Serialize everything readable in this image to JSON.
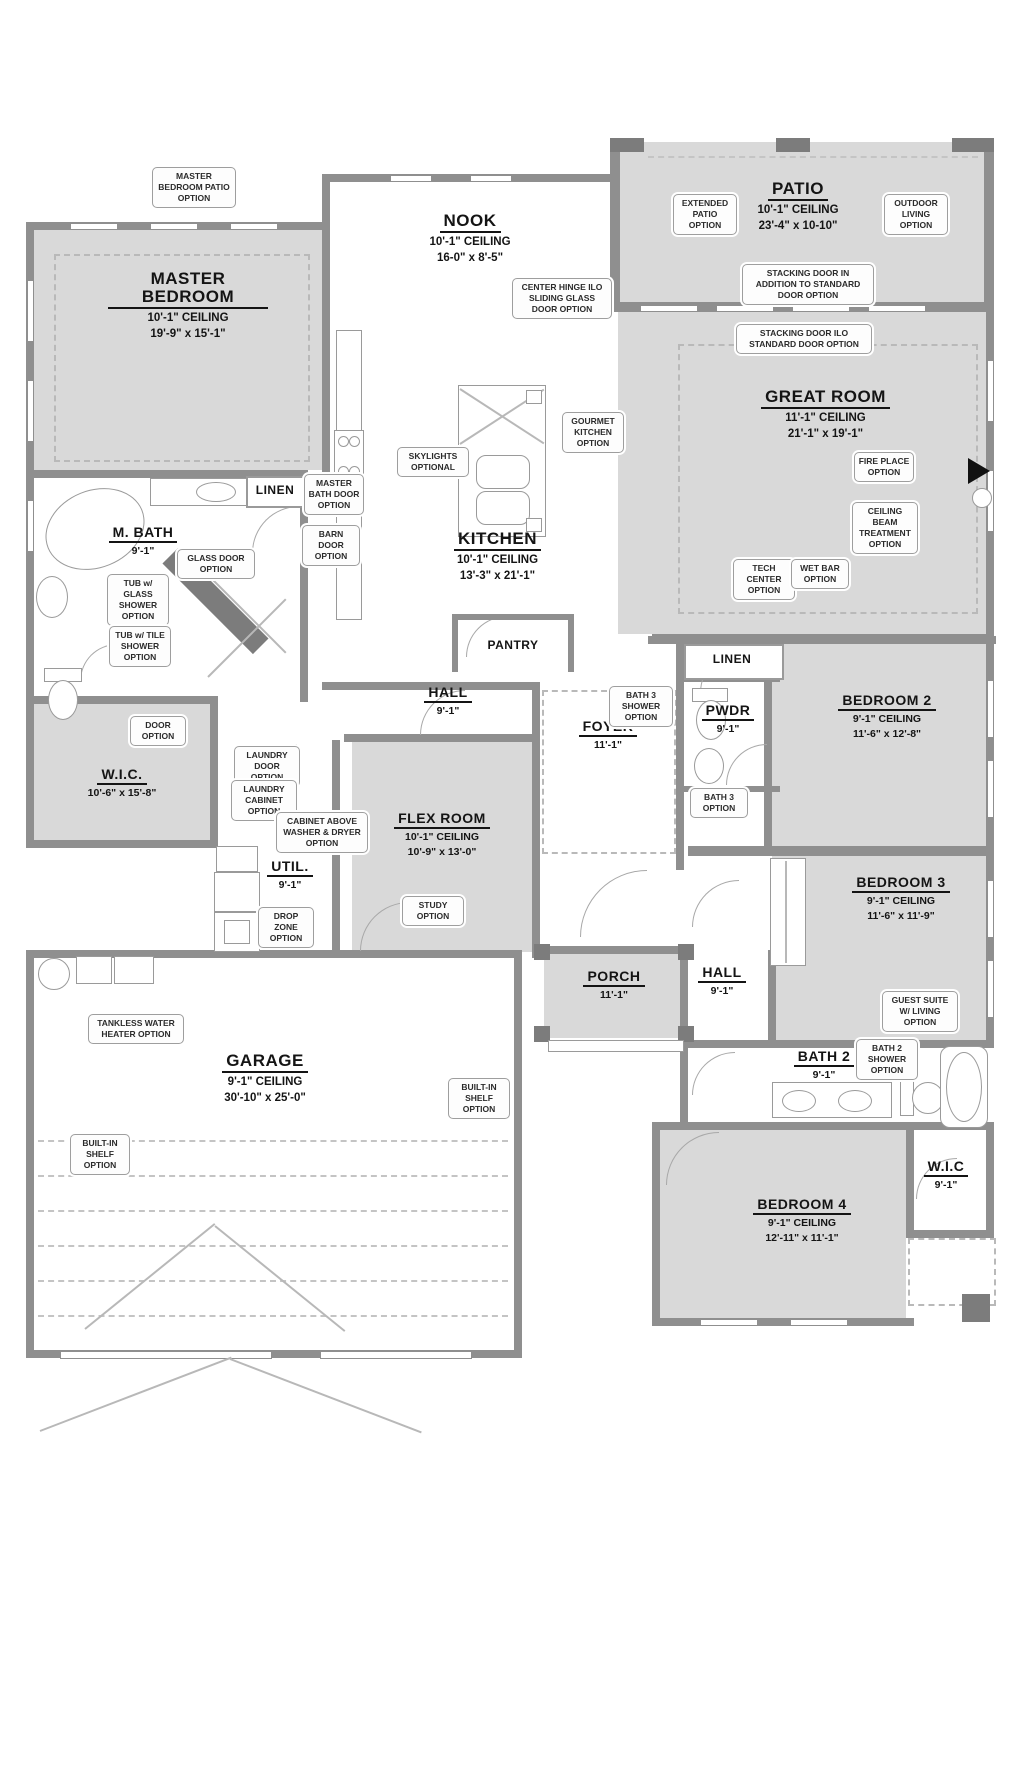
{
  "plan": {
    "title": "Floor Plan",
    "rooms": {
      "master_bedroom": {
        "name": "MASTER BEDROOM",
        "ceiling": "10'-1\" CEILING",
        "dims": "19'-9\" x 15'-1\""
      },
      "nook": {
        "name": "NOOK",
        "ceiling": "10'-1\" CEILING",
        "dims": "16-0\" x 8'-5\""
      },
      "patio": {
        "name": "PATIO",
        "ceiling": "10'-1\" CEILING",
        "dims": "23'-4\" x 10-10\""
      },
      "great_room": {
        "name": "GREAT ROOM",
        "ceiling": "11'-1\" CEILING",
        "dims": "21'-1\" x 19'-1\""
      },
      "kitchen": {
        "name": "KITCHEN",
        "ceiling": "10'-1\" CEILING",
        "dims": "13'-3\" x 21'-1\""
      },
      "m_bath": {
        "name": "M. BATH",
        "ceiling": "9'-1\""
      },
      "linen_master": {
        "name": "LINEN"
      },
      "pantry": {
        "name": "PANTRY"
      },
      "hall_center": {
        "name": "HALL",
        "ceiling": "9'-1\""
      },
      "foyer": {
        "name": "FOYER",
        "ceiling": "11'-1\""
      },
      "linen_hall": {
        "name": "LINEN"
      },
      "pwdr": {
        "name": "PWDR",
        "ceiling": "9'-1\""
      },
      "wic_master": {
        "name": "W.I.C.",
        "dims": "10'-6\" x 15'-8\""
      },
      "util": {
        "name": "UTIL.",
        "ceiling": "9'-1\""
      },
      "flex_room": {
        "name": "FLEX ROOM",
        "ceiling": "10'-1\" CEILING",
        "dims": "10'-9\" x 13'-0\""
      },
      "bedroom_2": {
        "name": "BEDROOM 2",
        "ceiling": "9'-1\" CEILING",
        "dims": "11'-6\" x 12'-8\""
      },
      "bedroom_3": {
        "name": "BEDROOM 3",
        "ceiling": "9'-1\" CEILING",
        "dims": "11'-6\" x 11'-9\""
      },
      "porch": {
        "name": "PORCH",
        "ceiling": "11'-1\""
      },
      "hall_bed": {
        "name": "HALL",
        "ceiling": "9'-1\""
      },
      "bath_2": {
        "name": "BATH 2",
        "ceiling": "9'-1\""
      },
      "garage": {
        "name": "GARAGE",
        "ceiling": "9'-1\" CEILING",
        "dims": "30'-10\" x 25'-0\""
      },
      "bedroom_4": {
        "name": "BEDROOM 4",
        "ceiling": "9'-1\" CEILING",
        "dims": "12'-11\" x 11'-1\""
      },
      "wic_bed4": {
        "name": "W.I.C",
        "ceiling": "9'-1\""
      }
    },
    "options": {
      "master_patio": "MASTER BEDROOM PATIO OPTION",
      "center_hinge": "CENTER HINGE ILO SLIDING GLASS DOOR OPTION",
      "extended_patio": "EXTENDED PATIO OPTION",
      "outdoor_living": "OUTDOOR LIVING OPTION",
      "stacking_addition": "STACKING DOOR IN ADDITION TO STANDARD DOOR OPTION",
      "stacking_ilo": "STACKING DOOR ILO STANDARD DOOR OPTION",
      "gourmet_kitchen": "GOURMET KITCHEN OPTION",
      "skylights": "SKYLIGHTS OPTIONAL",
      "fireplace": "FIRE PLACE OPTION",
      "ceiling_beam": "CEILING BEAM TREATMENT OPTION",
      "tech_center": "TECH CENTER OPTION",
      "wet_bar": "WET BAR OPTION",
      "master_bath_door": "MASTER BATH DOOR OPTION",
      "barn_door": "BARN DOOR OPTION",
      "glass_door": "GLASS DOOR OPTION",
      "tub_glass": "TUB w/ GLASS SHOWER OPTION",
      "tub_tile": "TUB w/ TILE SHOWER OPTION",
      "door_option": "DOOR OPTION",
      "laundry_door": "LAUNDRY DOOR OPTION",
      "laundry_cabinet": "LAUNDRY CABINET OPTION",
      "cabinet_washer": "CABINET ABOVE WASHER & DRYER OPTION",
      "drop_zone": "DROP ZONE OPTION",
      "study": "STUDY OPTION",
      "bath3_shower": "BATH 3 SHOWER OPTION",
      "bath3": "BATH 3 OPTION",
      "guest_suite": "GUEST SUITE W/ LIVING OPTION",
      "bath2_shower": "BATH 2 SHOWER OPTION",
      "tankless": "TANKLESS WATER HEATER OPTION",
      "builtin_shelf_left": "BUILT-IN SHELF OPTION",
      "builtin_shelf_garage": "BUILT-IN SHELF OPTION"
    },
    "colors": {
      "room_fill": "#d9d9d9",
      "wall": "#8f8f8f",
      "callout_border": "#9e9e9e",
      "marker": "#111111"
    }
  }
}
